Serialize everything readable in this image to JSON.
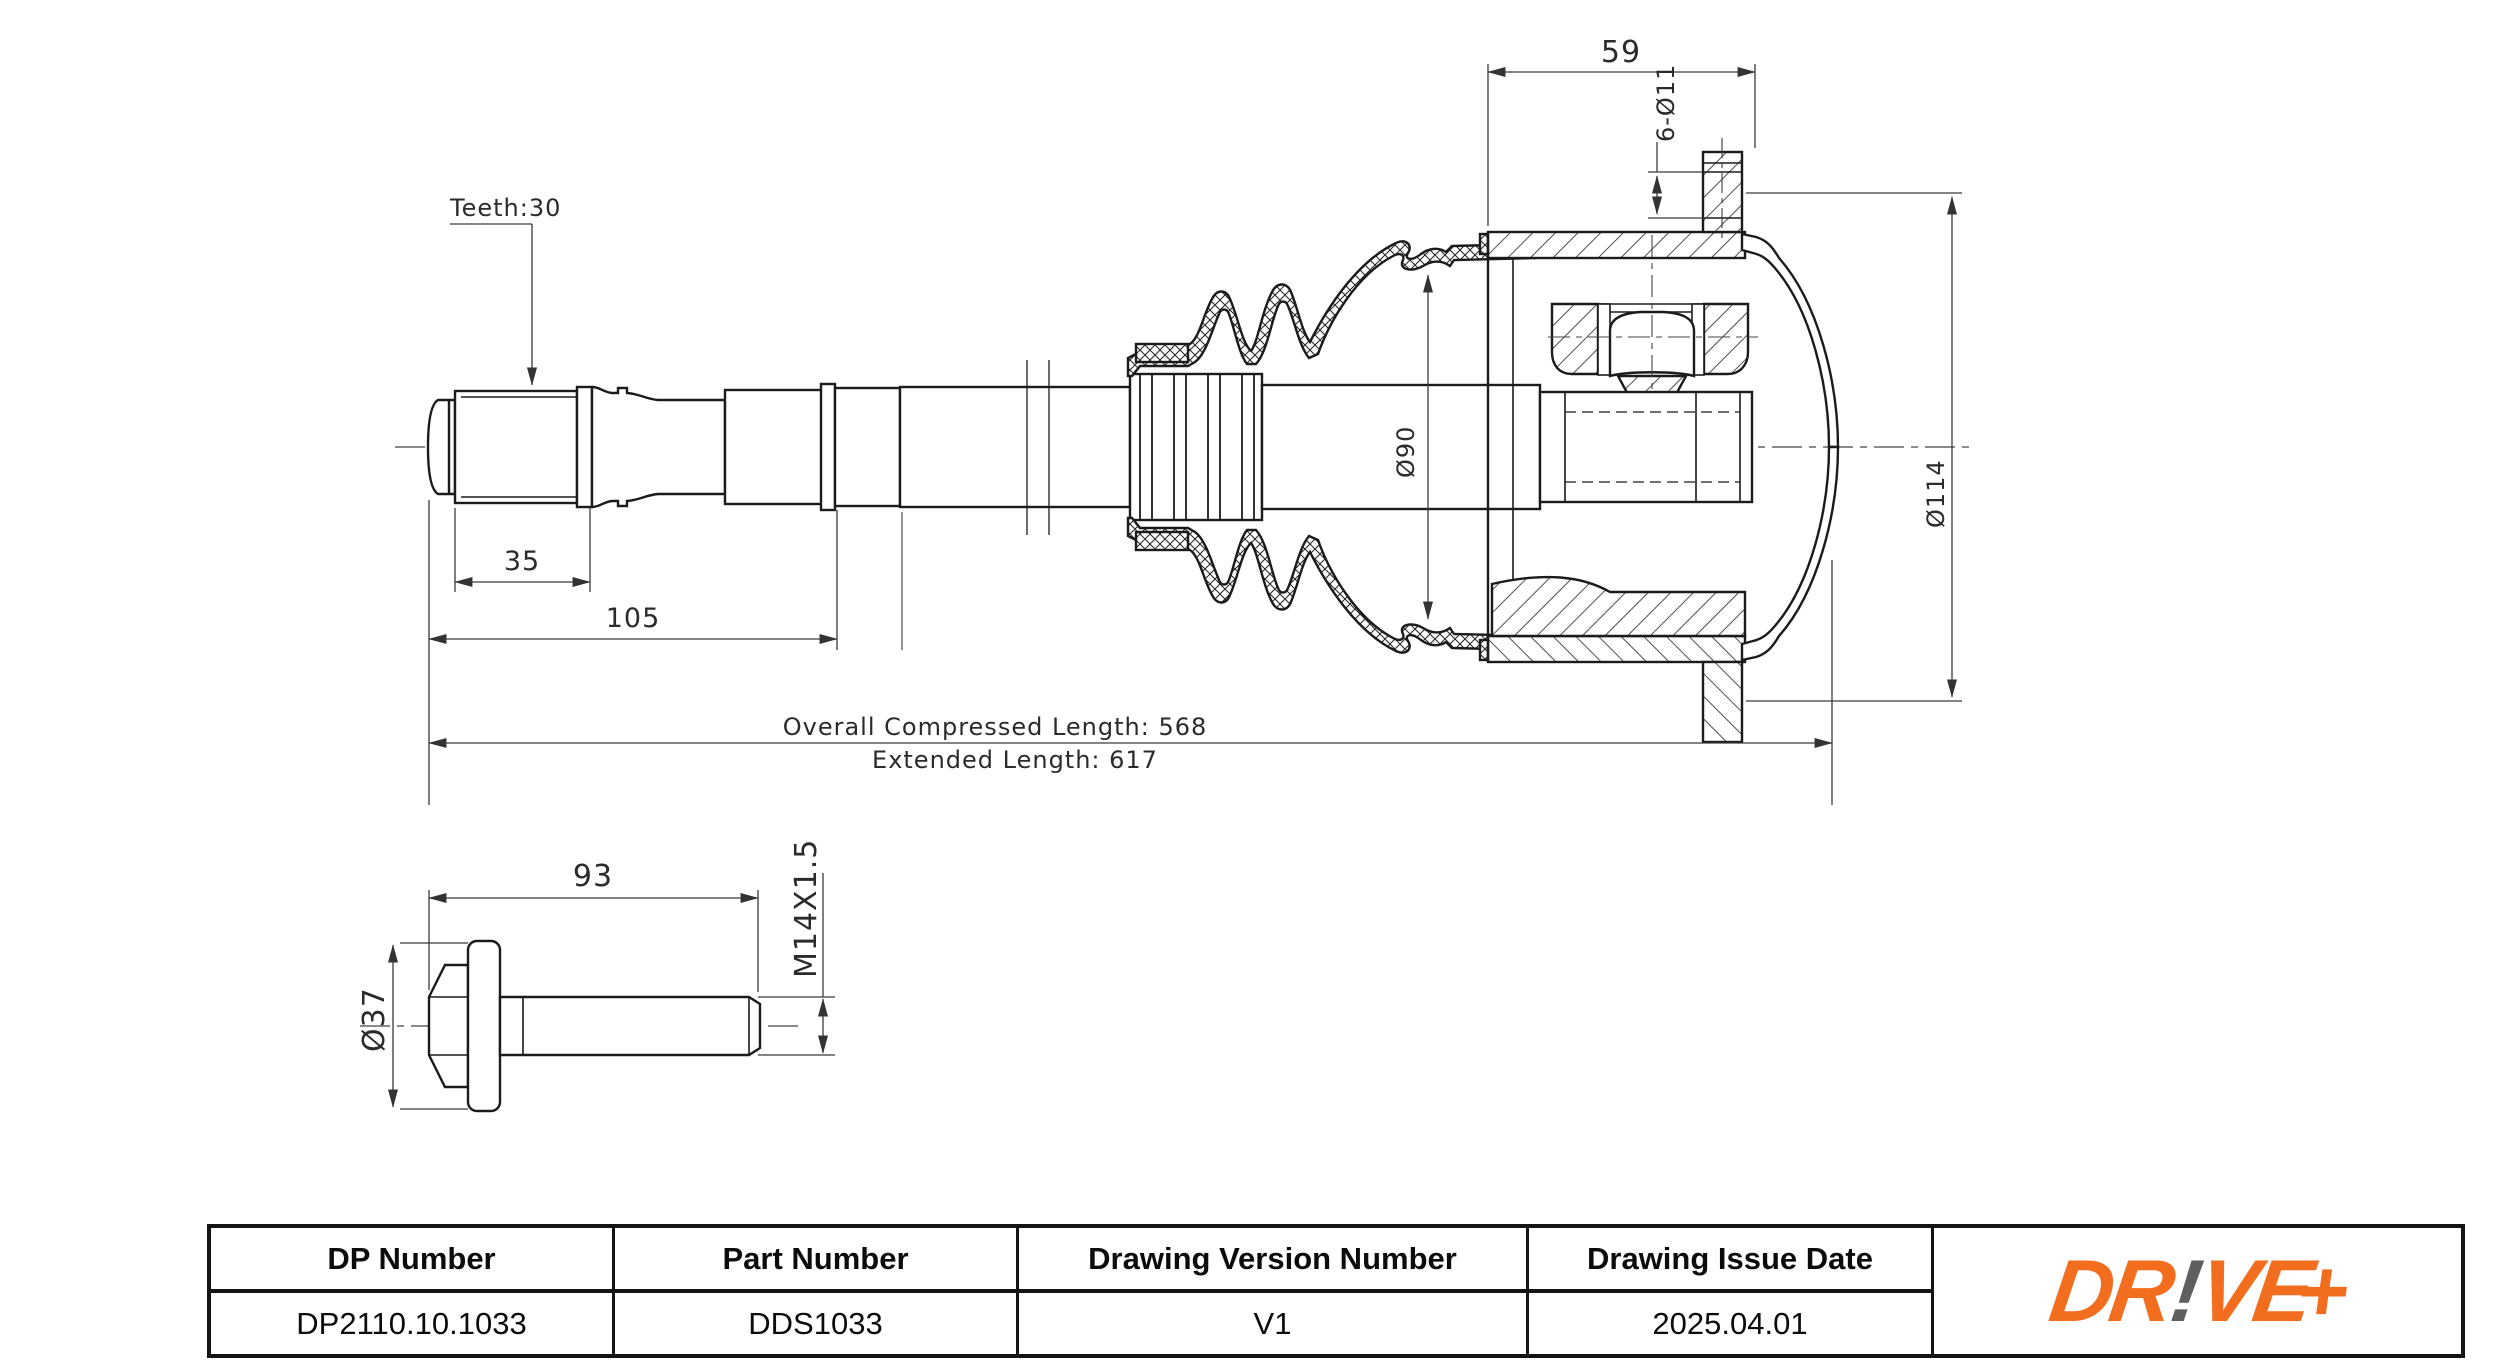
{
  "drawing": {
    "callouts": {
      "teeth": "Teeth:30",
      "flange_width": "59",
      "bolt_holes": "6-Ø11",
      "boot_dia": "Ø90",
      "flange_dia": "Ø114",
      "spline_length": "35",
      "stub_length": "105",
      "compressed_length": "Overall  Compressed  Length: 568",
      "extended_length": "Extended  Length: 617"
    },
    "bolt": {
      "length": "93",
      "thread": "M14X1.5",
      "head_dia": "Ø37"
    }
  },
  "title_block": {
    "headers": [
      "DP Number",
      "Part Number",
      "Drawing Version Number",
      "Drawing Issue Date"
    ],
    "values": [
      "DP2110.10.1033",
      "DDS1033",
      "V1",
      "2025.04.01"
    ]
  },
  "logo": {
    "part1": "DR",
    "bang": "!",
    "part2": "VE",
    "plus": "+",
    "orange": "#F26E1E",
    "gray": "#5f5f5f"
  },
  "colors": {
    "line": "#1b1b1b",
    "dim": "#3a3a3a",
    "background": "#ffffff"
  }
}
